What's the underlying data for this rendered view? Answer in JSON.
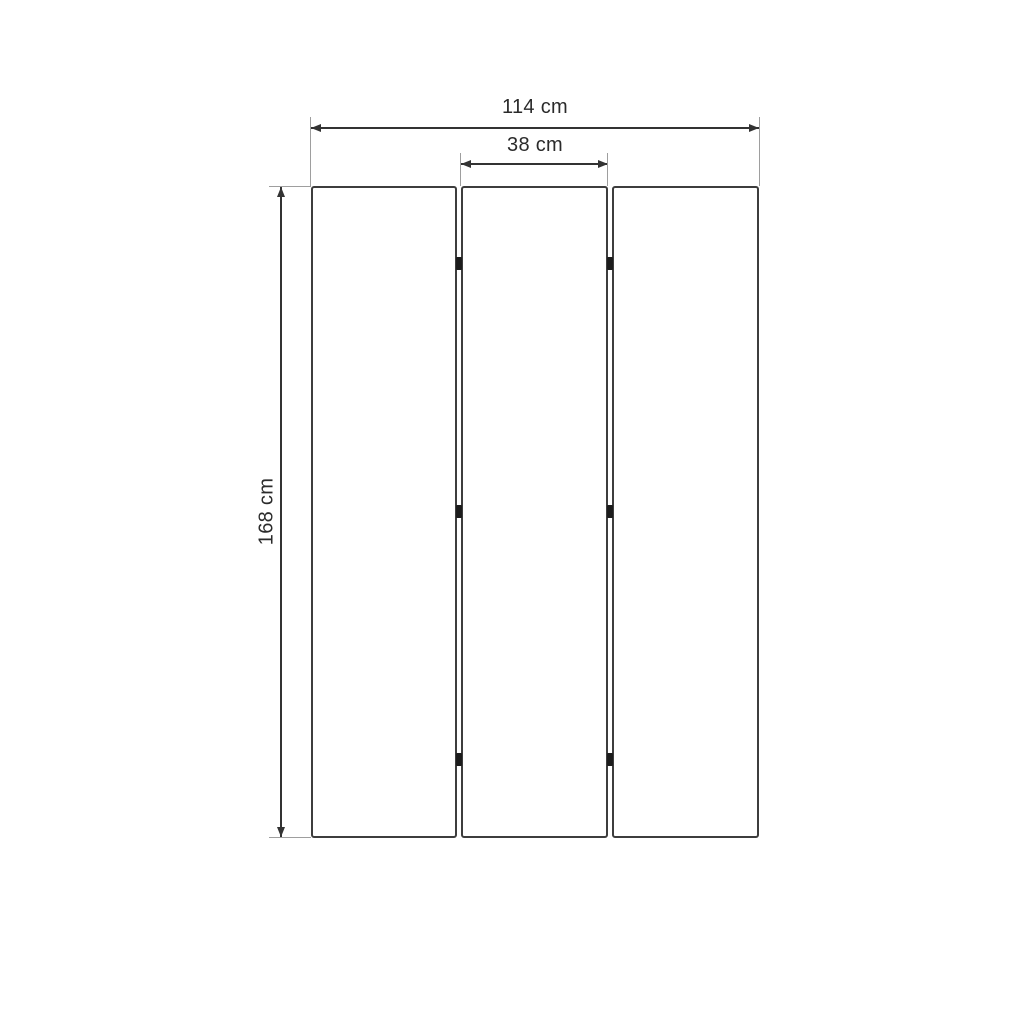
{
  "diagram": {
    "labels": {
      "total_width": "114 cm",
      "panel_width": "38 cm",
      "height": "168 cm"
    },
    "panel_count": 3,
    "hinge_marks_per_gap": 3,
    "colors": {
      "panel_outline": "#3d3d3d",
      "dimension_line": "#333333",
      "extension_line": "#9e9e9e",
      "hinge_mark": "#1c1c1c",
      "label_text": "#2b2b2b",
      "background": "#ffffff"
    }
  }
}
